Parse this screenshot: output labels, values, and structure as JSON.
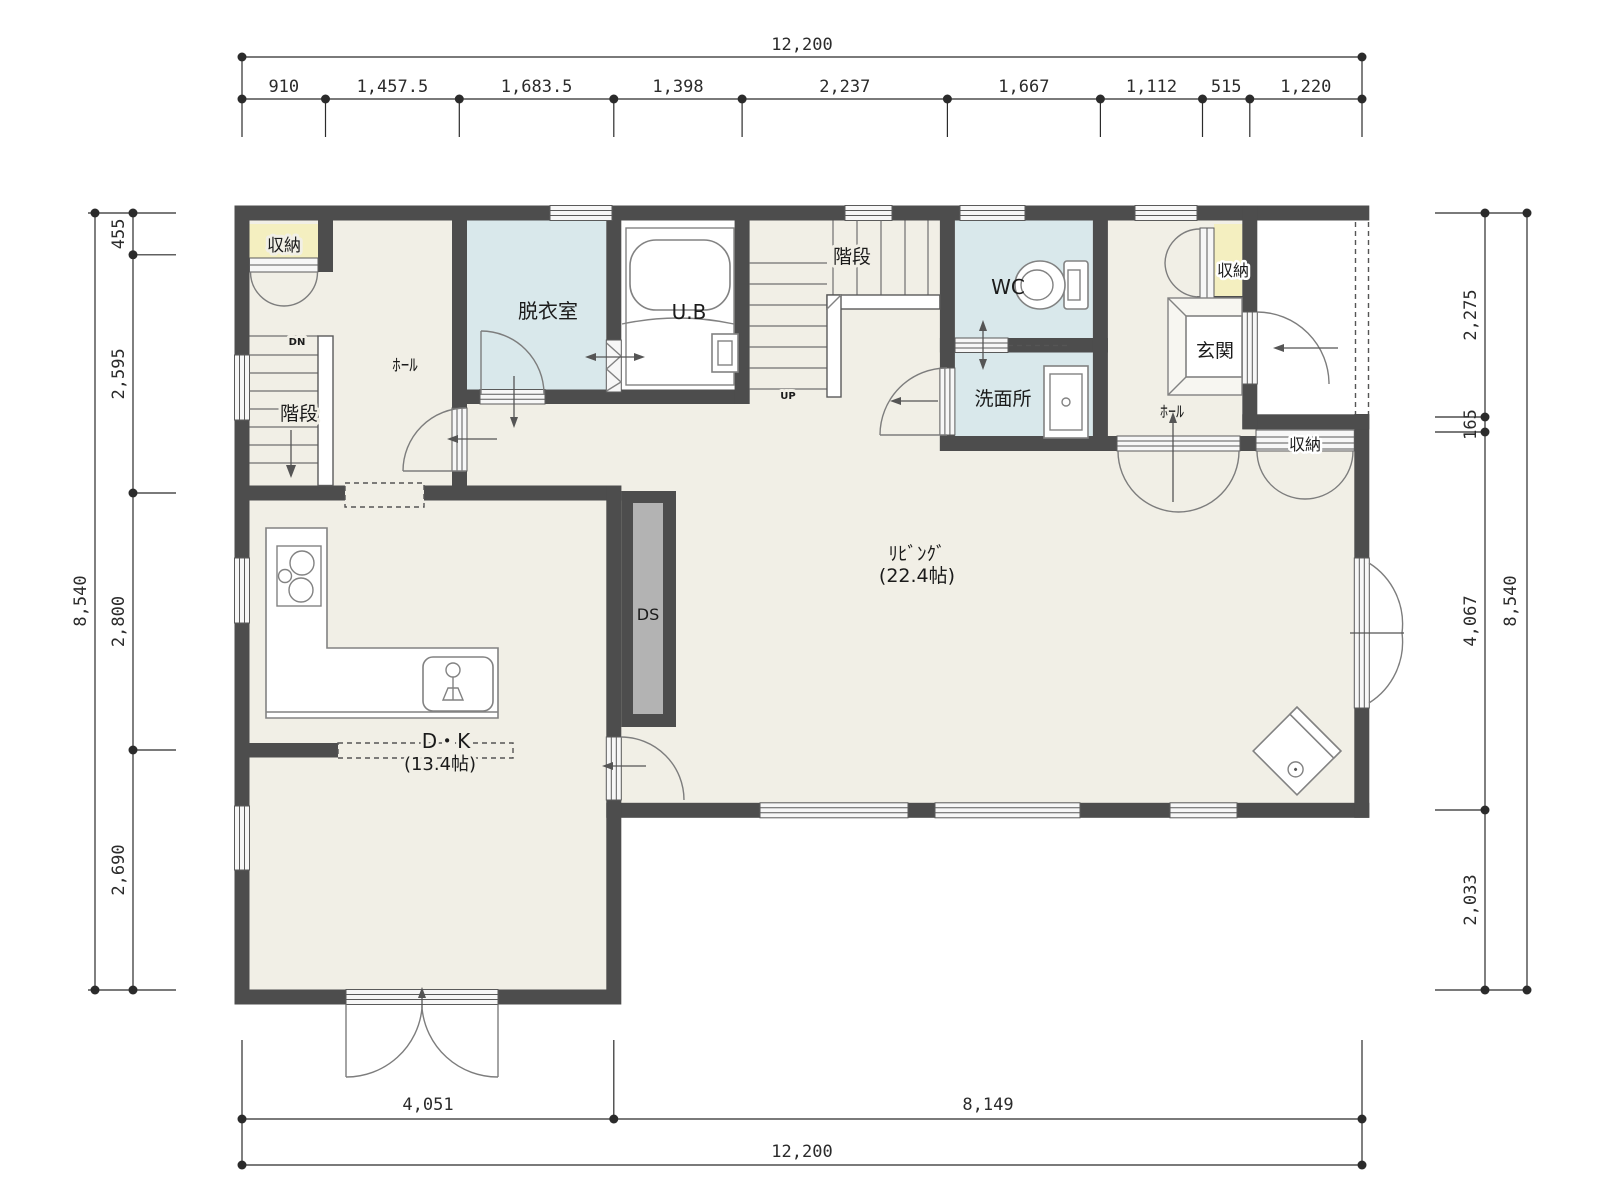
{
  "colors": {
    "wall": "#4d4d4d",
    "floor": "#f1efe6",
    "wet_room": "#d9e8eb",
    "closet": "#f4efc0",
    "duct_shaft": "#b3b3b3",
    "dimension": "#2b2b2b"
  },
  "rooms": {
    "living": {
      "label": "ﾘﾋﾞﾝｸﾞ",
      "size": "(22.4帖)"
    },
    "dk": {
      "label": "D・K",
      "size": "(13.4帖)"
    },
    "hall_left": {
      "label": "ﾎｰﾙ"
    },
    "hall_right": {
      "label": "ﾎｰﾙ"
    },
    "stairs_left": {
      "label": "階段",
      "direction": "DN"
    },
    "stairs_center": {
      "label": "階段",
      "direction": "UP"
    },
    "dressing_room": {
      "label": "脱衣室"
    },
    "unit_bath": {
      "label": "U.B"
    },
    "wc": {
      "label": "WC"
    },
    "washroom": {
      "label": "洗面所"
    },
    "entrance": {
      "label": "玄関"
    },
    "closet_top_left": {
      "label": "収納"
    },
    "closet_entry": {
      "label": "収納"
    },
    "closet_living": {
      "label": "収納"
    },
    "duct_space": {
      "label": "DS"
    }
  },
  "dimensions": {
    "top": {
      "total": "12,200",
      "segments": [
        "910",
        "1,457.5",
        "1,683.5",
        "1,398",
        "2,237",
        "1,667",
        "1,112",
        "515",
        "1,220"
      ]
    },
    "bottom": {
      "total": "12,200",
      "segments": [
        "4,051",
        "8,149"
      ]
    },
    "left": {
      "total": "8,540",
      "segments": [
        "455",
        "2,595",
        "2,800",
        "2,690"
      ]
    },
    "right": {
      "total": "8,540",
      "segments": [
        "2,275",
        "165",
        "4,067",
        "2,033"
      ]
    }
  }
}
